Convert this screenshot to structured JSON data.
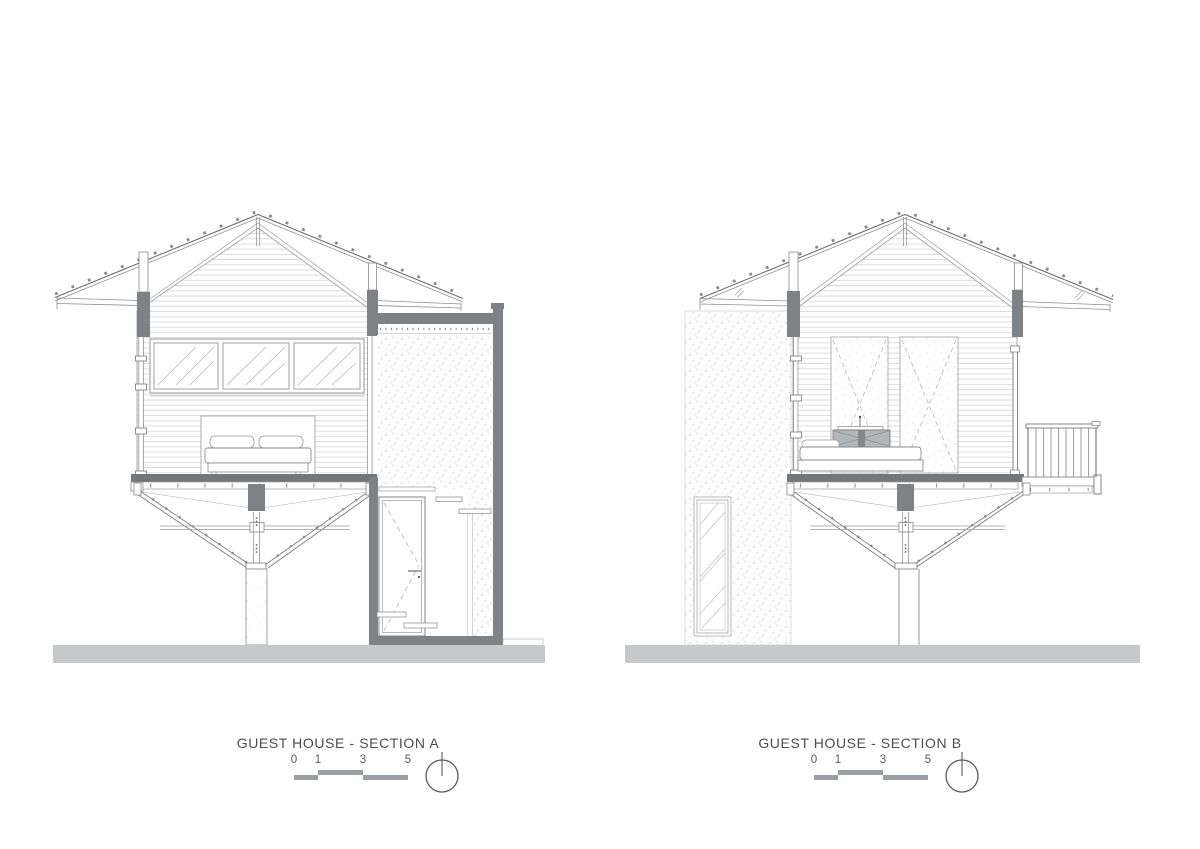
{
  "document": {
    "type": "architectural-section-sheet",
    "background": "#ffffff"
  },
  "sections": [
    {
      "id": "section-a",
      "title": "GUEST HOUSE - SECTION A",
      "scale": {
        "labels": [
          "0",
          "1",
          "3",
          "5"
        ]
      },
      "compass_icon": "north-arrow",
      "drawing_features": [
        "gable-roof",
        "clerestory-windows",
        "double-bed",
        "v-shaped-truss",
        "support-column",
        "concrete-stair-tower",
        "entry-door",
        "ground-line"
      ]
    },
    {
      "id": "section-b",
      "title": "GUEST HOUSE - SECTION B",
      "scale": {
        "labels": [
          "0",
          "1",
          "3",
          "5"
        ]
      },
      "compass_icon": "north-arrow",
      "drawing_features": [
        "gable-roof",
        "concrete-wall",
        "tall-window",
        "wardrobe-panels",
        "bed-side-view",
        "balcony-railing",
        "v-shaped-truss",
        "support-column",
        "ground-line"
      ]
    }
  ],
  "colors": {
    "line": "#6e7072",
    "dark_fill": "#7e8284",
    "floor_fill": "#74777a",
    "ground_fill": "#c6c8ca",
    "scale_bar": "#9b9fa2",
    "text": "#4b4d4f"
  }
}
